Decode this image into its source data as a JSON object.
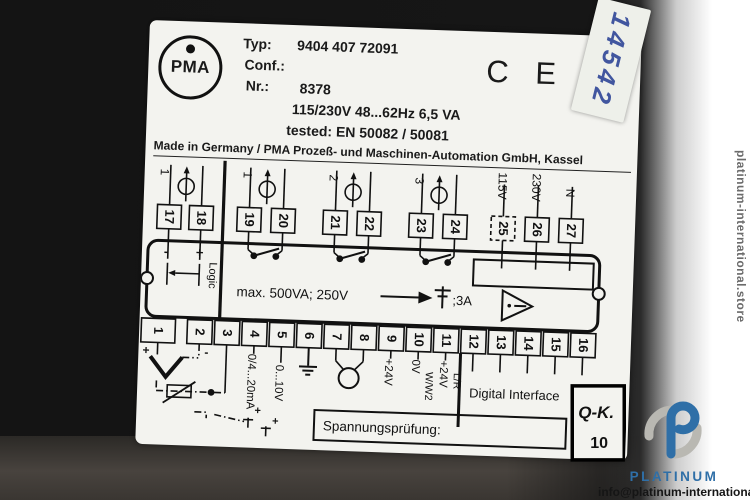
{
  "colors": {
    "device_black": "#141414",
    "label_white": "#f3f3ef",
    "brand_blue": "#2f6fa7",
    "sticker_ink_blue": "#41569f"
  },
  "sticker": {
    "handwritten_number": "14542"
  },
  "stamp": {
    "line1": "Q-K.",
    "line2": "10"
  },
  "watermark": {
    "vertical_text": "platinum-international.store",
    "brand": "PLATINUM",
    "email": "info@platinum-international.store"
  },
  "label": {
    "logo_text": "PMA",
    "typ_label": "Typ:",
    "typ_value": "9404 407 72091",
    "conf_label": "Conf.:",
    "nr_label": "Nr.:",
    "nr_value": "8378",
    "power_line": "115/230V  48...62Hz  6,5 VA",
    "tested_line": "tested: EN 50082 / 50081",
    "ce_mark": "C E",
    "origin_line": "Made in Germany / PMA Prozeß- und Maschinen-Automation GmbH, Kassel"
  },
  "diagram": {
    "top_terminals": [
      "17",
      "18",
      "19",
      "20",
      "21",
      "22",
      "23",
      "24",
      "25",
      "26",
      "27"
    ],
    "bottom_terminals": [
      "1",
      "2",
      "3",
      "4",
      "5",
      "6",
      "7",
      "8",
      "9",
      "10",
      "11",
      "12",
      "13",
      "14",
      "15",
      "16"
    ],
    "input_group_labels": [
      "1",
      "1",
      "2",
      "3"
    ],
    "mains_labels": [
      "115V",
      "230V",
      "N"
    ],
    "logic_label": "Logic",
    "minus": "-",
    "plus": "+",
    "tc_plus": "+",
    "tc_minus": "-",
    "relay_rating": "max. 500VA; 250V",
    "fuse_rating": ";3A",
    "col4_label": "0/4...20mA",
    "col5_label": "0...10V",
    "col9_label": "+24V",
    "col10_label_a": "0V",
    "col10_label_b": "W/W2",
    "col11_label_a": "+24V",
    "col11_label_b": "L/R",
    "digital_interface": "Digital Interface",
    "test_box_label": "Spannungsprüfung:"
  }
}
